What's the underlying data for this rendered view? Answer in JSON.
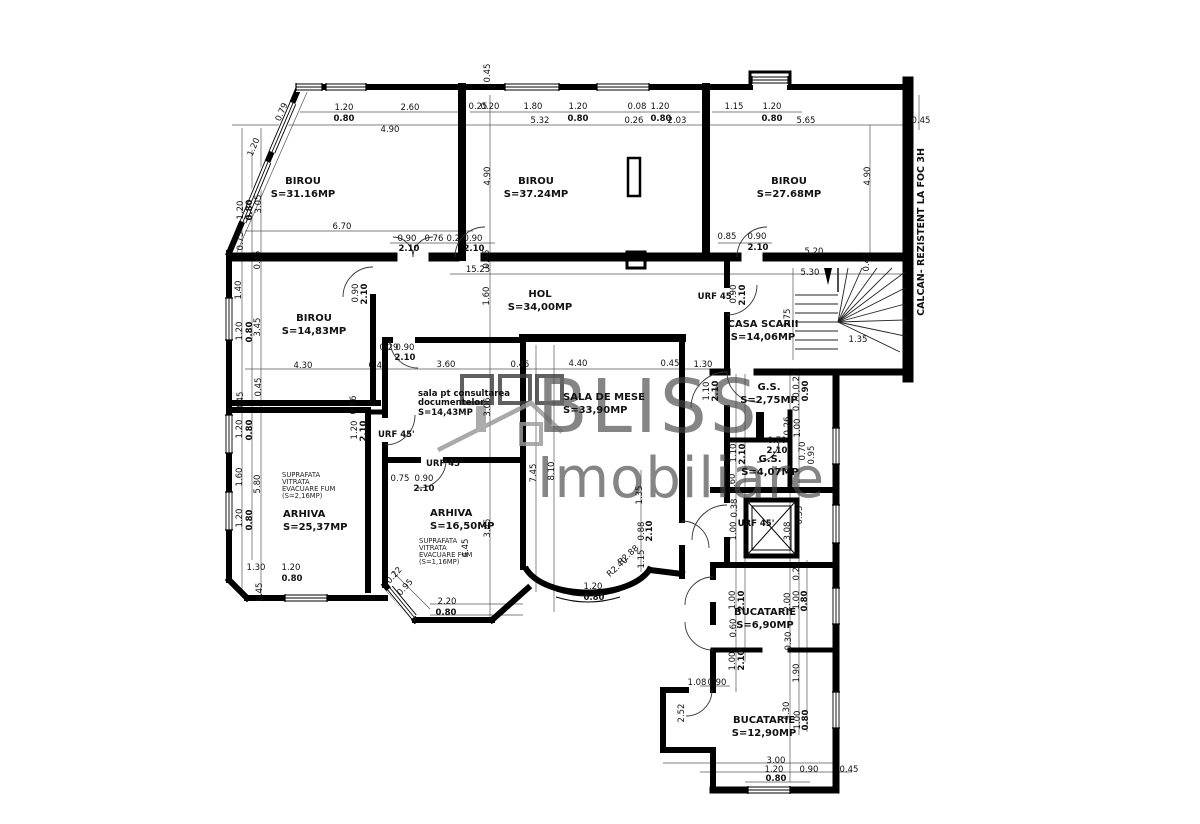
{
  "watermark": {
    "line1": "BLISS",
    "line2": "Imobiliare"
  },
  "side_note": "CALCAN- REZISTENT LA FOC 3H",
  "rooms": [
    {
      "n": "BIROU",
      "a": "S=31.16MP",
      "x": 303,
      "y": 184
    },
    {
      "n": "BIROU",
      "a": "S=37.24MP",
      "x": 536,
      "y": 184
    },
    {
      "n": "BIROU",
      "a": "S=27.68MP",
      "x": 789,
      "y": 184
    },
    {
      "n": "BIROU",
      "a": "S=14,83MP",
      "x": 314,
      "y": 321
    },
    {
      "n": "HOL",
      "a": "S=34,00MP",
      "x": 540,
      "y": 297
    },
    {
      "n": "CASA SCARII",
      "a": "S=14,06MP",
      "x": 763,
      "y": 327
    },
    {
      "n": "sala pt consultarea\ndocumentelor",
      "a": "S=14,43MP",
      "x": 418,
      "y": 396,
      "left": 1,
      "small": 1
    },
    {
      "n": "SALA DE MESE",
      "a": "S=33,90MP",
      "x": 563,
      "y": 400,
      "left": 1
    },
    {
      "n": "G.S.",
      "a": "S=2,75MP",
      "x": 769,
      "y": 390
    },
    {
      "n": "G.S.",
      "a": "S=4,07MP",
      "x": 770,
      "y": 462
    },
    {
      "n": "ARHIVA",
      "a": "S=25,37MP",
      "x": 283,
      "y": 517,
      "left": 1
    },
    {
      "n": "ARHIVA",
      "a": "S=16,50MP",
      "x": 430,
      "y": 516,
      "left": 1
    },
    {
      "n": "BUCATARIE",
      "a": "S=6,90MP",
      "x": 765,
      "y": 615
    },
    {
      "n": "BUCATARIE",
      "a": "S=12,90MP",
      "x": 764,
      "y": 723
    }
  ],
  "notes": [
    {
      "lines": [
        "SUPRAFATA",
        "VITRATA",
        "EVACUARE FUM",
        "(S=2,16MP)"
      ],
      "x": 282,
      "y": 477
    },
    {
      "lines": [
        "SUPRAFATA",
        "VITRATA",
        "EVACUARE FUM",
        "(S=1,16MP)"
      ],
      "x": 419,
      "y": 543
    }
  ],
  "annotations": [
    [
      "1.20",
      344,
      110
    ],
    [
      "2.60",
      410,
      110
    ],
    [
      "0.80",
      344,
      121,
      0,
      1
    ],
    [
      "4.90",
      390,
      132
    ],
    [
      "1.20",
      256,
      148,
      -67
    ],
    [
      "0.79",
      284,
      113,
      -67
    ],
    [
      "1.20",
      243,
      210,
      -90
    ],
    [
      "0.80",
      252,
      210,
      -90,
      1
    ],
    [
      "3.05",
      261,
      204,
      -90
    ],
    [
      "0.75",
      243,
      241,
      -90
    ],
    [
      "6.70",
      342,
      229
    ],
    [
      "0.90",
      407,
      241
    ],
    [
      "0.76",
      434,
      241
    ],
    [
      "2.10",
      409,
      251,
      0,
      1
    ],
    [
      "0.25",
      456,
      241
    ],
    [
      "0.90",
      473,
      241
    ],
    [
      "2.10",
      474,
      251,
      0,
      1
    ],
    [
      "0.45",
      490,
      73,
      -90
    ],
    [
      "0.25",
      478,
      109
    ],
    [
      "0.20",
      490,
      109
    ],
    [
      "1.80",
      533,
      109
    ],
    [
      "1.20",
      578,
      109
    ],
    [
      "0.80",
      578,
      121,
      0,
      1
    ],
    [
      "5.32",
      540,
      123
    ],
    [
      "0.08",
      637,
      109
    ],
    [
      "1.20",
      660,
      109
    ],
    [
      "0.26",
      634,
      123
    ],
    [
      "0.80",
      661,
      121,
      0,
      1
    ],
    [
      "2.03",
      677,
      123
    ],
    [
      "4.90",
      490,
      176,
      -90
    ],
    [
      "1.15",
      734,
      109
    ],
    [
      "1.20",
      772,
      109
    ],
    [
      "0.80",
      772,
      121,
      0,
      1
    ],
    [
      "5.65",
      806,
      123
    ],
    [
      "0.45",
      921,
      123
    ],
    [
      "4.90",
      870,
      176,
      -90
    ],
    [
      "0.85",
      727,
      239
    ],
    [
      "0.90",
      757,
      239
    ],
    [
      "2.10",
      758,
      250,
      0,
      1
    ],
    [
      "15.25",
      478,
      272
    ],
    [
      "0.45",
      489,
      259,
      -90
    ],
    [
      "1.60",
      489,
      296,
      -90
    ],
    [
      "URF 45'",
      716,
      299,
      0,
      1
    ],
    [
      "0.90",
      736,
      294,
      -90
    ],
    [
      "2.10",
      745,
      295,
      -90,
      1
    ],
    [
      "5.20",
      814,
      254
    ],
    [
      "5.30",
      810,
      275
    ],
    [
      "2.75",
      790,
      318,
      -90
    ],
    [
      "0.45",
      869,
      262,
      -90
    ],
    [
      "1.35",
      858,
      342
    ],
    [
      "0.45",
      260,
      260,
      -90
    ],
    [
      "1.40",
      241,
      290,
      -90
    ],
    [
      "1.20",
      242,
      331,
      -90
    ],
    [
      "0.80",
      252,
      332,
      -90,
      1
    ],
    [
      "3.45",
      260,
      327,
      -90
    ],
    [
      "0.90",
      358,
      293,
      -90
    ],
    [
      "2.10",
      367,
      294,
      -90,
      1
    ],
    [
      "4.30",
      303,
      368
    ],
    [
      "0.45",
      378,
      368
    ],
    [
      "0.45",
      261,
      387,
      -90
    ],
    [
      "0.29",
      389,
      350
    ],
    [
      "0.90",
      405,
      350
    ],
    [
      "2.10",
      405,
      360,
      0,
      1
    ],
    [
      "3.60",
      446,
      367
    ],
    [
      "0.45",
      520,
      367
    ],
    [
      "4.40",
      578,
      366
    ],
    [
      "0.45",
      670,
      366
    ],
    [
      "1.30",
      703,
      367
    ],
    [
      "3.06",
      490,
      407,
      -90
    ],
    [
      "1.10",
      709,
      391,
      -90
    ],
    [
      "2.10",
      718,
      391,
      -90,
      1
    ],
    [
      "0.70,0.25",
      799,
      391,
      -90
    ],
    [
      "0.90",
      808,
      391,
      -90,
      1
    ],
    [
      "0.26",
      790,
      426,
      -90
    ],
    [
      "1.00",
      800,
      428,
      -90
    ],
    [
      "0.70",
      777,
      443
    ],
    [
      "2.10",
      777,
      453,
      0,
      1
    ],
    [
      "1.10",
      736,
      453,
      -90
    ],
    [
      "2.10",
      745,
      454,
      -90,
      1
    ],
    [
      "0.70",
      805,
      451,
      -90
    ],
    [
      "0.95",
      814,
      455,
      -90
    ],
    [
      "0.60",
      735,
      483,
      -90
    ],
    [
      "0.38",
      737,
      508,
      -90
    ],
    [
      "1.00",
      736,
      531,
      -90
    ],
    [
      "URF 45'",
      756,
      526,
      0,
      1
    ],
    [
      "0.55",
      802,
      515,
      -90
    ],
    [
      "3.08",
      790,
      531,
      -90
    ],
    [
      "0.25",
      799,
      571,
      -90
    ],
    [
      "2.00",
      790,
      602,
      -90
    ],
    [
      "1.00",
      799,
      600,
      -90
    ],
    [
      "0.80",
      807,
      601,
      -90,
      1
    ],
    [
      "1.00",
      735,
      600,
      -90
    ],
    [
      "2.10",
      744,
      601,
      -90,
      1
    ],
    [
      "0.60",
      736,
      628,
      -90
    ],
    [
      "1.00",
      735,
      661,
      -90
    ],
    [
      "2.10",
      744,
      660,
      -90,
      1
    ],
    [
      "0.30",
      791,
      641,
      -90
    ],
    [
      "1.90",
      799,
      673,
      -90
    ],
    [
      "1.08",
      697,
      685
    ],
    [
      "0.90",
      717,
      685
    ],
    [
      "4.30",
      789,
      711,
      -90
    ],
    [
      "1.00",
      800,
      720,
      -90
    ],
    [
      "0.80",
      808,
      720,
      -90,
      1
    ],
    [
      "2.52",
      684,
      713,
      -90
    ],
    [
      "3.00",
      776,
      763
    ],
    [
      "1.20",
      774,
      772
    ],
    [
      "0.90",
      809,
      772
    ],
    [
      "0.45",
      849,
      772
    ],
    [
      "0.80",
      776,
      781,
      0,
      1
    ],
    [
      "0.45",
      243,
      401,
      -90
    ],
    [
      "1.20",
      242,
      429,
      -90
    ],
    [
      "0.80",
      252,
      430,
      -90,
      1
    ],
    [
      "1.60",
      242,
      477,
      -90
    ],
    [
      "5.80",
      260,
      484,
      -90
    ],
    [
      "1.20",
      242,
      518,
      -90
    ],
    [
      "0.80",
      252,
      520,
      -90,
      1
    ],
    [
      "1.30",
      256,
      570
    ],
    [
      "1.20",
      291,
      570
    ],
    [
      "0.80",
      292,
      581,
      0,
      1
    ],
    [
      "0.45",
      262,
      592,
      -90
    ],
    [
      "0.86",
      356,
      405,
      -90
    ],
    [
      "1.20",
      357,
      430,
      -90
    ],
    [
      "2.10",
      366,
      431,
      -90,
      1
    ],
    [
      "URF 45'",
      378,
      437,
      0,
      1,
      1
    ],
    [
      "URF 45'",
      426,
      466,
      0,
      1,
      1
    ],
    [
      "0.75",
      400,
      481
    ],
    [
      "0.90",
      424,
      481
    ],
    [
      "2.10",
      424,
      491,
      0,
      1
    ],
    [
      "0.22",
      396,
      577,
      -48
    ],
    [
      "0.95",
      407,
      589,
      -48
    ],
    [
      "2.20",
      447,
      604
    ],
    [
      "0.80",
      446,
      615,
      0,
      1
    ],
    [
      "3.45",
      490,
      528,
      -90
    ],
    [
      "4.45",
      468,
      548,
      -90
    ],
    [
      "7.45",
      536,
      473,
      -90
    ],
    [
      "8.10",
      554,
      471,
      -90
    ],
    [
      "1.35",
      642,
      495,
      -90
    ],
    [
      "0.88",
      644,
      531,
      -90
    ],
    [
      "2.10",
      652,
      531,
      -90,
      1
    ],
    [
      "1.15",
      644,
      559,
      -90
    ],
    [
      "R2.88",
      630,
      557,
      -42
    ],
    [
      "R2.40",
      619,
      569,
      -42
    ],
    [
      "1.20",
      593,
      589
    ],
    [
      "0.80",
      594,
      600,
      0,
      1
    ]
  ]
}
